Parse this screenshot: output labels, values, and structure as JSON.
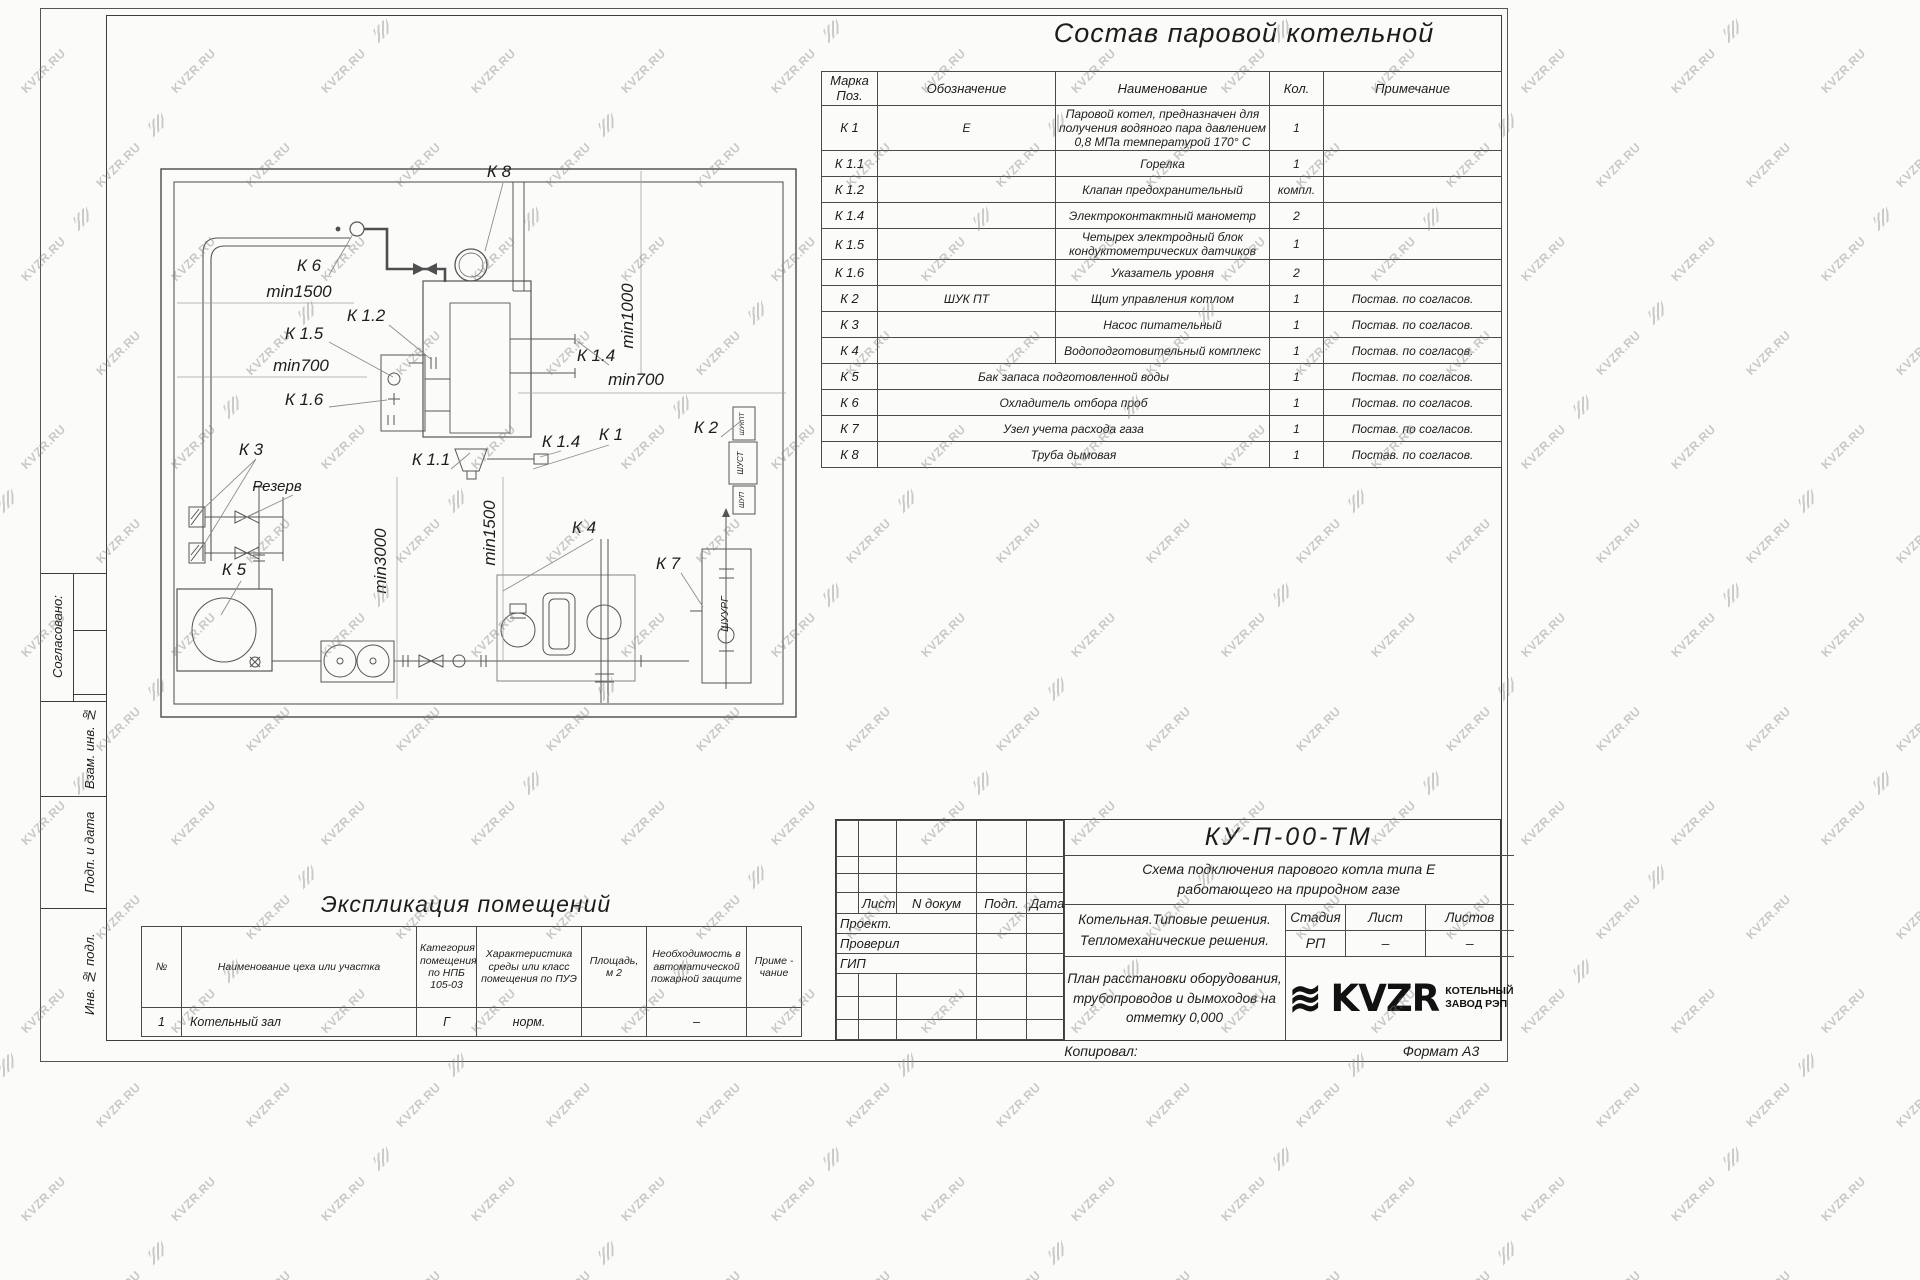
{
  "watermark": {
    "text": "KVZR.RU"
  },
  "sheet": {
    "title": "Состав паровой котельной",
    "sidebar": {
      "approved": "Согласовано:",
      "vzam": "Взам. инв. №",
      "podp": "Подп. и дата",
      "inv": "Инв. № подл."
    },
    "equipment_table": {
      "headers": {
        "mark": "Марка Поз.",
        "designation": "Обозначение",
        "name": "Наименование",
        "qty": "Кол.",
        "note": "Примечание"
      },
      "rows": [
        {
          "mark": "К 1",
          "designation": "Е",
          "name": "Паровой котел, предназначен для получения водяного пара давлением  0,8  МПа температурой  170° С",
          "qty": "1",
          "note": ""
        },
        {
          "mark": "К 1.1",
          "designation": "",
          "name": "Горелка",
          "qty": "1",
          "note": ""
        },
        {
          "mark": "К 1.2",
          "designation": "",
          "name": "Клапан предохранительный",
          "qty": "компл.",
          "note": ""
        },
        {
          "mark": "К 1.4",
          "designation": "",
          "name": "Электроконтактный манометр",
          "qty": "2",
          "note": ""
        },
        {
          "mark": "К 1.5",
          "designation": "",
          "name": "Четырех электродный блок кондуктометрических датчиков",
          "qty": "1",
          "note": ""
        },
        {
          "mark": "К 1.6",
          "designation": "",
          "name": "Указатель уровня",
          "qty": "2",
          "note": ""
        },
        {
          "mark": "К 2",
          "designation": "ШУК ПТ",
          "name": "Щит управления котлом",
          "qty": "1",
          "note": "Постав. по согласов."
        },
        {
          "mark": "К 3",
          "designation": "",
          "name": "Насос питательный",
          "qty": "1",
          "note": "Постав. по согласов."
        },
        {
          "mark": "К 4",
          "designation": "",
          "name": "Водоподготовительный комплекс",
          "qty": "1",
          "note": "Постав. по согласов."
        },
        {
          "mark": "К 5",
          "designation": "Бак запаса подготовленной воды",
          "name": "",
          "qty": "1",
          "note": "Постав. по согласов."
        },
        {
          "mark": "К 6",
          "designation": "Охладитель отбора проб",
          "name": "",
          "qty": "1",
          "note": "Постав. по согласов."
        },
        {
          "mark": "К 7",
          "designation": "Узел учета расхода газа",
          "name": "",
          "qty": "1",
          "note": "Постав. по согласов."
        },
        {
          "mark": "К 8",
          "designation": "Труба дымовая",
          "name": "",
          "qty": "1",
          "note": "Постав. по согласов."
        }
      ]
    },
    "plan": {
      "labels": [
        {
          "t": "К 8",
          "x": 358,
          "y": 36
        },
        {
          "t": "К 6",
          "x": 168,
          "y": 130
        },
        {
          "t": "min1500",
          "x": 158,
          "y": 156
        },
        {
          "t": "К 1.2",
          "x": 225,
          "y": 180
        },
        {
          "t": "К 1.5",
          "x": 163,
          "y": 198
        },
        {
          "t": "min700",
          "x": 160,
          "y": 230
        },
        {
          "t": "К 1.6",
          "x": 163,
          "y": 264
        },
        {
          "t": "К 3",
          "x": 110,
          "y": 314
        },
        {
          "t": "Резерв",
          "x": 136,
          "y": 350,
          "s": 15
        },
        {
          "t": "К 5",
          "x": 93,
          "y": 434
        },
        {
          "t": "min3000",
          "x": 245,
          "y": 420,
          "v": true
        },
        {
          "t": "min1500",
          "x": 354,
          "y": 392,
          "v": true
        },
        {
          "t": "К 1.1",
          "x": 290,
          "y": 324
        },
        {
          "t": "К 1.4",
          "x": 420,
          "y": 306
        },
        {
          "t": "К 1",
          "x": 470,
          "y": 299
        },
        {
          "t": "К 1.4",
          "x": 455,
          "y": 220
        },
        {
          "t": "min1000",
          "x": 492,
          "y": 175,
          "v": true
        },
        {
          "t": "min700",
          "x": 495,
          "y": 244
        },
        {
          "t": "К 2",
          "x": 565,
          "y": 292
        },
        {
          "t": "К 4",
          "x": 443,
          "y": 392
        },
        {
          "t": "К 7",
          "x": 527,
          "y": 428
        },
        {
          "t": "ШУКПТ",
          "x": 603,
          "y": 283,
          "v": true,
          "s": 6.5
        },
        {
          "t": "ШУСТ",
          "x": 602,
          "y": 322,
          "v": true,
          "s": 8
        },
        {
          "t": "ШУП",
          "x": 603,
          "y": 359,
          "v": true,
          "s": 7
        },
        {
          "t": "ШУУРГ",
          "x": 587,
          "y": 473,
          "v": true,
          "s": 10.5
        }
      ]
    },
    "explication": {
      "title": "Экспликация помещений",
      "headers": [
        "№",
        "Наименование цеха или участка",
        "Категория помещения по НПБ 105-03",
        "Характеристика среды или класс помещения по ПУЭ",
        "Площадь, м 2",
        "Необходимость в автоматической пожарной защите",
        "Приме - чание"
      ],
      "rows": [
        [
          "1",
          "Котельный зал",
          "Г",
          "норм.",
          "",
          "–",
          ""
        ]
      ]
    },
    "title_block": {
      "doc_number": "КУ-П-00-ТМ",
      "scheme_title": [
        "Схема подключения парового котла типа Е",
        "работающего на природном газе"
      ],
      "object_lines": [
        "Котельная.Типовые решения.",
        "Тепломеханические решения."
      ],
      "drawing_name_lines": [
        "План расстановки оборудования,",
        "трубопроводов и дымоходов на",
        "отметку  0,000"
      ],
      "header_cols": [
        "Лист",
        "N докум",
        "Подп.",
        "Дата"
      ],
      "roles": [
        "Проект.",
        "Проверил",
        "ГИП"
      ],
      "stage_col": "Стадия",
      "sheet_col": "Лист",
      "sheets_col": "Листов",
      "stage_val": "РП",
      "sheet_val": "–",
      "sheets_val": "–",
      "logo_text": "KVZR",
      "logo_caption": [
        "КОТЕЛЬНЫЙ",
        "ЗАВОД РЭП"
      ],
      "copied_label": "Копировал:",
      "format_label": "Формат А3"
    }
  }
}
